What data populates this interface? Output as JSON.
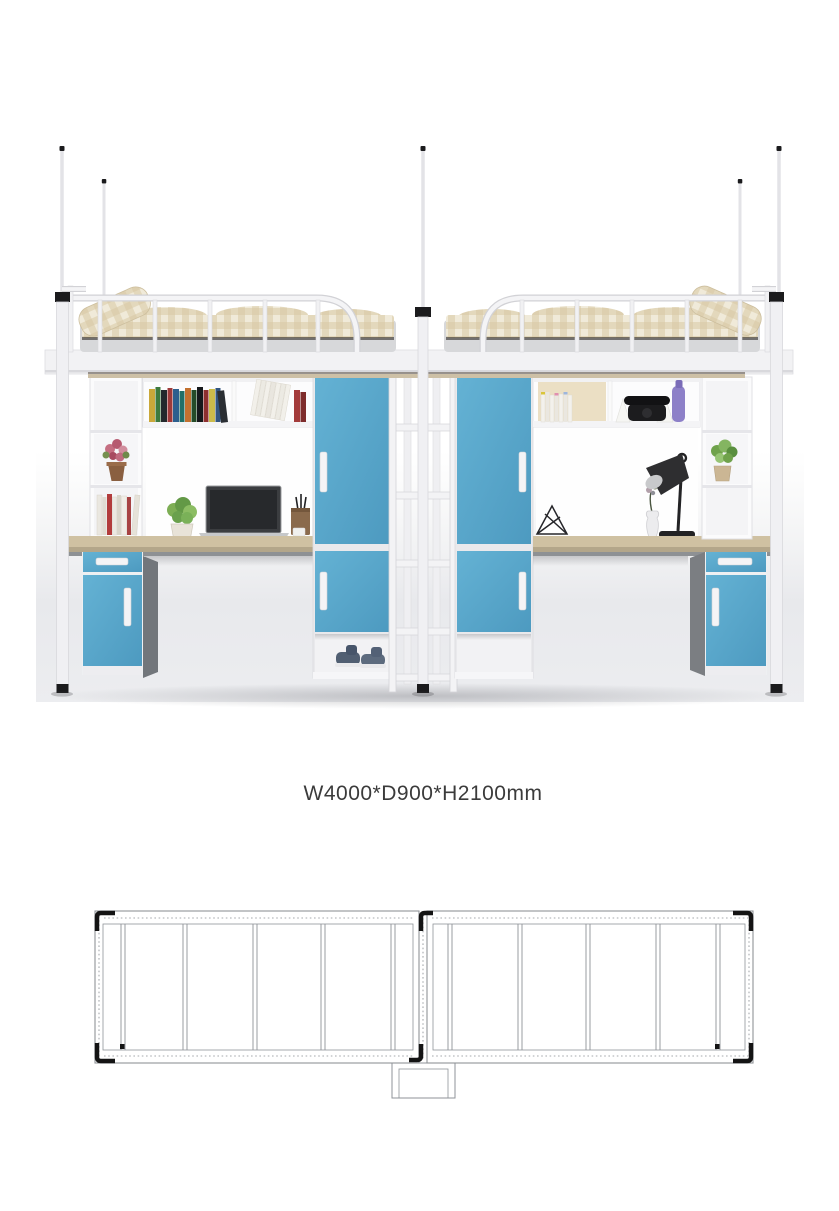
{
  "page": {
    "background": "#ffffff"
  },
  "product": {
    "name": "double-loft-bed-with-desks-and-wardrobes",
    "dimensions_label": "W4000*D900*H2100mm"
  },
  "render": {
    "accent_blue": "#58a8cb",
    "frame_white": "#f3f3f5",
    "desk_wood": "#cfc1a2",
    "bedding_plaid": "#d8c8a3",
    "mattress_gray": "#d7d8da",
    "cabinet_side_gray": "#72767b",
    "elements": [
      "curtain-poles",
      "plaid-bedding",
      "guardrails",
      "bookshelves",
      "desk-left",
      "laptop",
      "potted-plant",
      "pen-holder",
      "wardrobe-left",
      "wardrobe-right",
      "ladder",
      "shoes",
      "desk-lamp",
      "vase",
      "wire-ornament",
      "telephone",
      "purple-bottle",
      "flower-cubby",
      "drawer-cabinets"
    ]
  },
  "plan_view": {
    "type": "top-view line drawing, two bed frames with center ladder box",
    "line_color": "#8f9398",
    "dotted_color": "#a6a9ad",
    "bracket_color": "#141414",
    "slats_left": [
      123,
      185,
      255,
      323,
      393
    ],
    "slats_right": [
      450,
      520,
      588,
      658,
      718
    ]
  },
  "label": {
    "text_color": "#3b3b3b"
  }
}
